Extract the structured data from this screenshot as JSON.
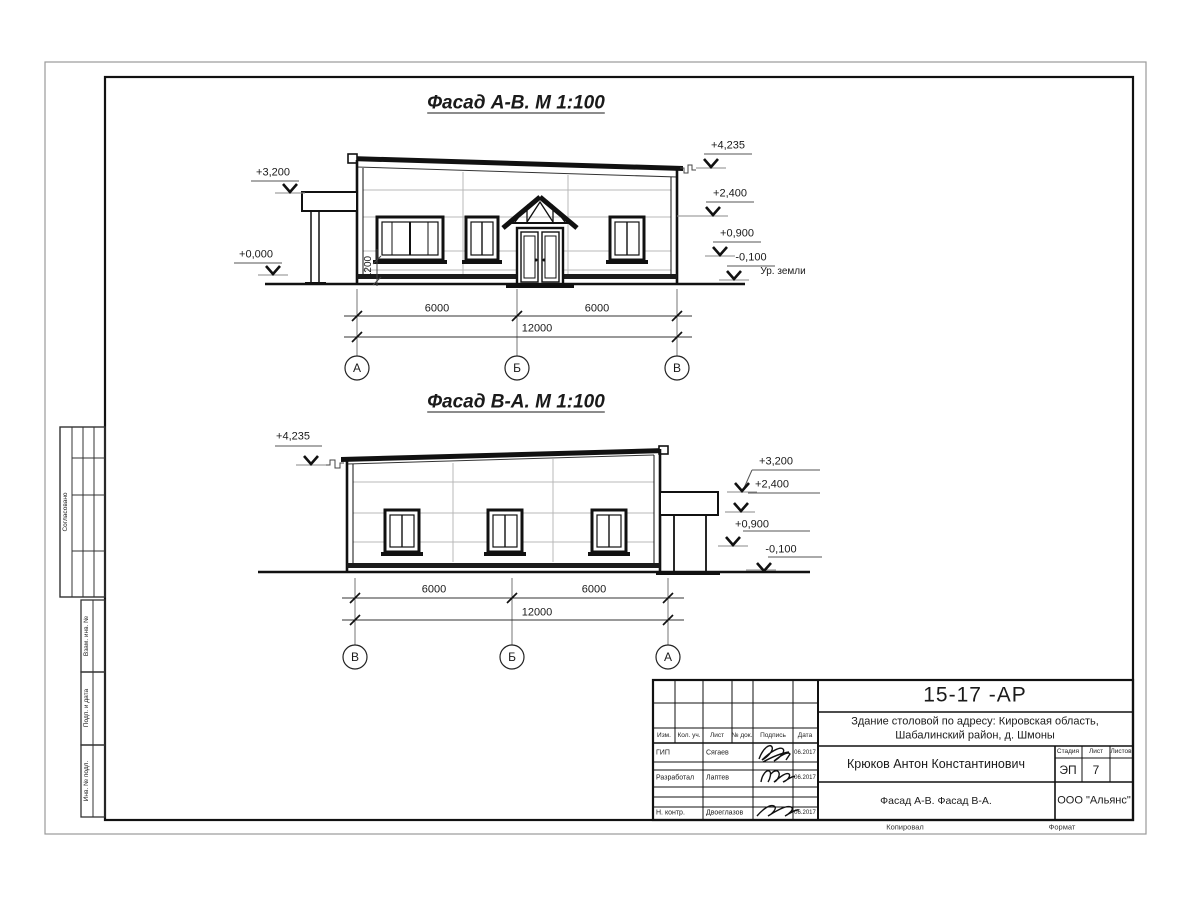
{
  "drawing": {
    "facade_av": {
      "title": "Фасад А-В.  М 1:100",
      "marks": {
        "left_top": "+3,200",
        "left_zero": "+0,000",
        "right_top": "+4,235",
        "right_upper": "+2,400",
        "right_mid": "+0,900",
        "right_ground": "-0,100",
        "ground_label": "Ур. земли",
        "sill_height": "1200"
      },
      "dims": {
        "span1": "6000",
        "span2": "6000",
        "total": "12000"
      },
      "axes": [
        "А",
        "Б",
        "В"
      ]
    },
    "facade_va": {
      "title": "Фасад В-А.  М 1:100",
      "marks": {
        "left_top": "+4,235",
        "right_top": "+3,200",
        "right_upper": "+2,400",
        "right_mid": "+0,900",
        "right_ground": "-0,100"
      },
      "dims": {
        "span1": "6000",
        "span2": "6000",
        "total": "12000"
      },
      "axes": [
        "В",
        "Б",
        "А"
      ]
    }
  },
  "side_stamp": {
    "agreed": "Согласовано",
    "zam_inv": "Взам. инв. №",
    "podp_data": "Подп. и дата",
    "inv_podl": "Инв. № подл."
  },
  "title_block": {
    "doc_number": "15-17 -АР",
    "project_line1": "Здание столовой по адресу: Кировская область,",
    "project_line2": "Шабалинский район, д. Шмоны",
    "author": "Крюков Антон Константинович",
    "drawing_title": "Фасад А-В. Фасад В-А.",
    "company": "ООО \"Альянс\"",
    "columns": {
      "izm": "Изм.",
      "kol_uch": "Кол. уч.",
      "list": "Лист",
      "doc": "№ док.",
      "podpis": "Подпись",
      "data": "Дата"
    },
    "stage": {
      "label": "Стадия",
      "value": "ЭП"
    },
    "sheet": {
      "label": "Лист",
      "value": "7"
    },
    "sheets": {
      "label": "Листов",
      "value": ""
    },
    "rows": [
      {
        "role": "ГИП",
        "name": "Сягаев",
        "date": "06.2017"
      },
      {
        "role": "Разработал",
        "name": "Лаптев",
        "date": "06.2017"
      },
      {
        "role": "Н. контр.",
        "name": "Двоеглазов",
        "date": "06.2017"
      }
    ],
    "footer": {
      "copied": "Копировал",
      "format": "Формат"
    }
  }
}
